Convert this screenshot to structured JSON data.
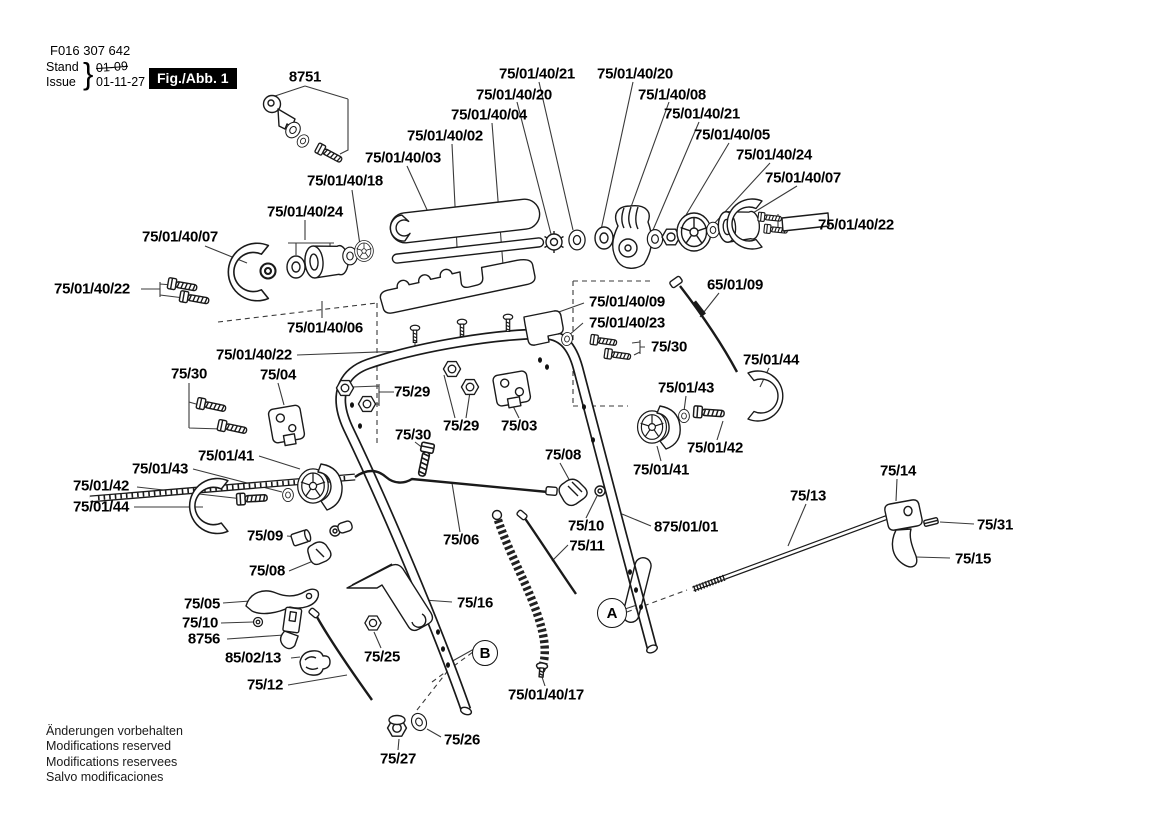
{
  "page": {
    "background": "#ffffff",
    "line_color": "#1a1a1a",
    "accent": "#000000"
  },
  "header": {
    "doc_number": "F016 307 642",
    "stand_label": "Stand",
    "issue_label": "Issue",
    "brace": "}",
    "superseded_date": "01-09",
    "issue_date": "01-11-27",
    "figure_label": "Fig./Abb. 1"
  },
  "footer": {
    "lines": [
      "Änderungen vorbehalten",
      "Modifications reserved",
      "Modifications reservees",
      "Salvo modificaciones"
    ]
  },
  "diagram": {
    "markers": [
      {
        "id": "A",
        "x": 612,
        "y": 613,
        "d": 28
      },
      {
        "id": "B",
        "x": 485,
        "y": 653,
        "d": 24
      }
    ],
    "labels": [
      {
        "text": "8751",
        "x": 305,
        "y": 77
      },
      {
        "text": "75/01/40/21",
        "x": 537,
        "y": 74
      },
      {
        "text": "75/01/40/20",
        "x": 635,
        "y": 74
      },
      {
        "text": "75/01/40/20",
        "x": 514,
        "y": 95
      },
      {
        "text": "75/1/40/08",
        "x": 672,
        "y": 95
      },
      {
        "text": "75/01/40/04",
        "x": 489,
        "y": 115
      },
      {
        "text": "75/01/40/21",
        "x": 702,
        "y": 114
      },
      {
        "text": "75/01/40/02",
        "x": 445,
        "y": 136
      },
      {
        "text": "75/01/40/05",
        "x": 732,
        "y": 135
      },
      {
        "text": "75/01/40/03",
        "x": 403,
        "y": 158
      },
      {
        "text": "75/01/40/24",
        "x": 774,
        "y": 155
      },
      {
        "text": "75/01/40/18",
        "x": 345,
        "y": 181
      },
      {
        "text": "75/01/40/07",
        "x": 803,
        "y": 178
      },
      {
        "text": "75/01/40/24",
        "x": 305,
        "y": 212
      },
      {
        "text": "75/01/40/22",
        "x": 856,
        "y": 225
      },
      {
        "text": "75/01/40/07",
        "x": 180,
        "y": 237
      },
      {
        "text": "75/01/40/22",
        "x": 92,
        "y": 289
      },
      {
        "text": "75/01/40/06",
        "x": 325,
        "y": 328
      },
      {
        "text": "65/01/09",
        "x": 735,
        "y": 285
      },
      {
        "text": "75/01/40/09",
        "x": 627,
        "y": 302
      },
      {
        "text": "75/01/40/23",
        "x": 627,
        "y": 323
      },
      {
        "text": "75/30",
        "x": 669,
        "y": 347
      },
      {
        "text": "75/01/44",
        "x": 771,
        "y": 360
      },
      {
        "text": "75/01/40/22",
        "x": 254,
        "y": 355
      },
      {
        "text": "75/30",
        "x": 189,
        "y": 374
      },
      {
        "text": "75/04",
        "x": 278,
        "y": 375
      },
      {
        "text": "75/29",
        "x": 412,
        "y": 392
      },
      {
        "text": "75/01/43",
        "x": 686,
        "y": 388
      },
      {
        "text": "75/29",
        "x": 461,
        "y": 426
      },
      {
        "text": "75/03",
        "x": 519,
        "y": 426
      },
      {
        "text": "75/30",
        "x": 413,
        "y": 435
      },
      {
        "text": "75/01/42",
        "x": 715,
        "y": 448
      },
      {
        "text": "75/14",
        "x": 898,
        "y": 471
      },
      {
        "text": "75/08",
        "x": 563,
        "y": 455
      },
      {
        "text": "75/01/41",
        "x": 661,
        "y": 470
      },
      {
        "text": "75/01/41",
        "x": 226,
        "y": 456
      },
      {
        "text": "75/01/43",
        "x": 160,
        "y": 469
      },
      {
        "text": "75/01/42",
        "x": 101,
        "y": 486
      },
      {
        "text": "75/01/44",
        "x": 101,
        "y": 507
      },
      {
        "text": "75/13",
        "x": 808,
        "y": 496
      },
      {
        "text": "75/10",
        "x": 586,
        "y": 526
      },
      {
        "text": "75/11",
        "x": 587,
        "y": 546
      },
      {
        "text": "875/01/01",
        "x": 686,
        "y": 527
      },
      {
        "text": "75/31",
        "x": 995,
        "y": 525
      },
      {
        "text": "75/15",
        "x": 973,
        "y": 559
      },
      {
        "text": "75/06",
        "x": 461,
        "y": 540
      },
      {
        "text": "75/09",
        "x": 265,
        "y": 536
      },
      {
        "text": "75/08",
        "x": 267,
        "y": 571
      },
      {
        "text": "75/05",
        "x": 202,
        "y": 604
      },
      {
        "text": "75/10",
        "x": 200,
        "y": 623
      },
      {
        "text": "8756",
        "x": 204,
        "y": 639
      },
      {
        "text": "75/16",
        "x": 475,
        "y": 603
      },
      {
        "text": "85/02/13",
        "x": 253,
        "y": 658
      },
      {
        "text": "75/25",
        "x": 382,
        "y": 657
      },
      {
        "text": "75/12",
        "x": 265,
        "y": 685
      },
      {
        "text": "75/01/40/17",
        "x": 546,
        "y": 695
      },
      {
        "text": "75/26",
        "x": 462,
        "y": 740
      },
      {
        "text": "75/27",
        "x": 398,
        "y": 759
      }
    ]
  }
}
